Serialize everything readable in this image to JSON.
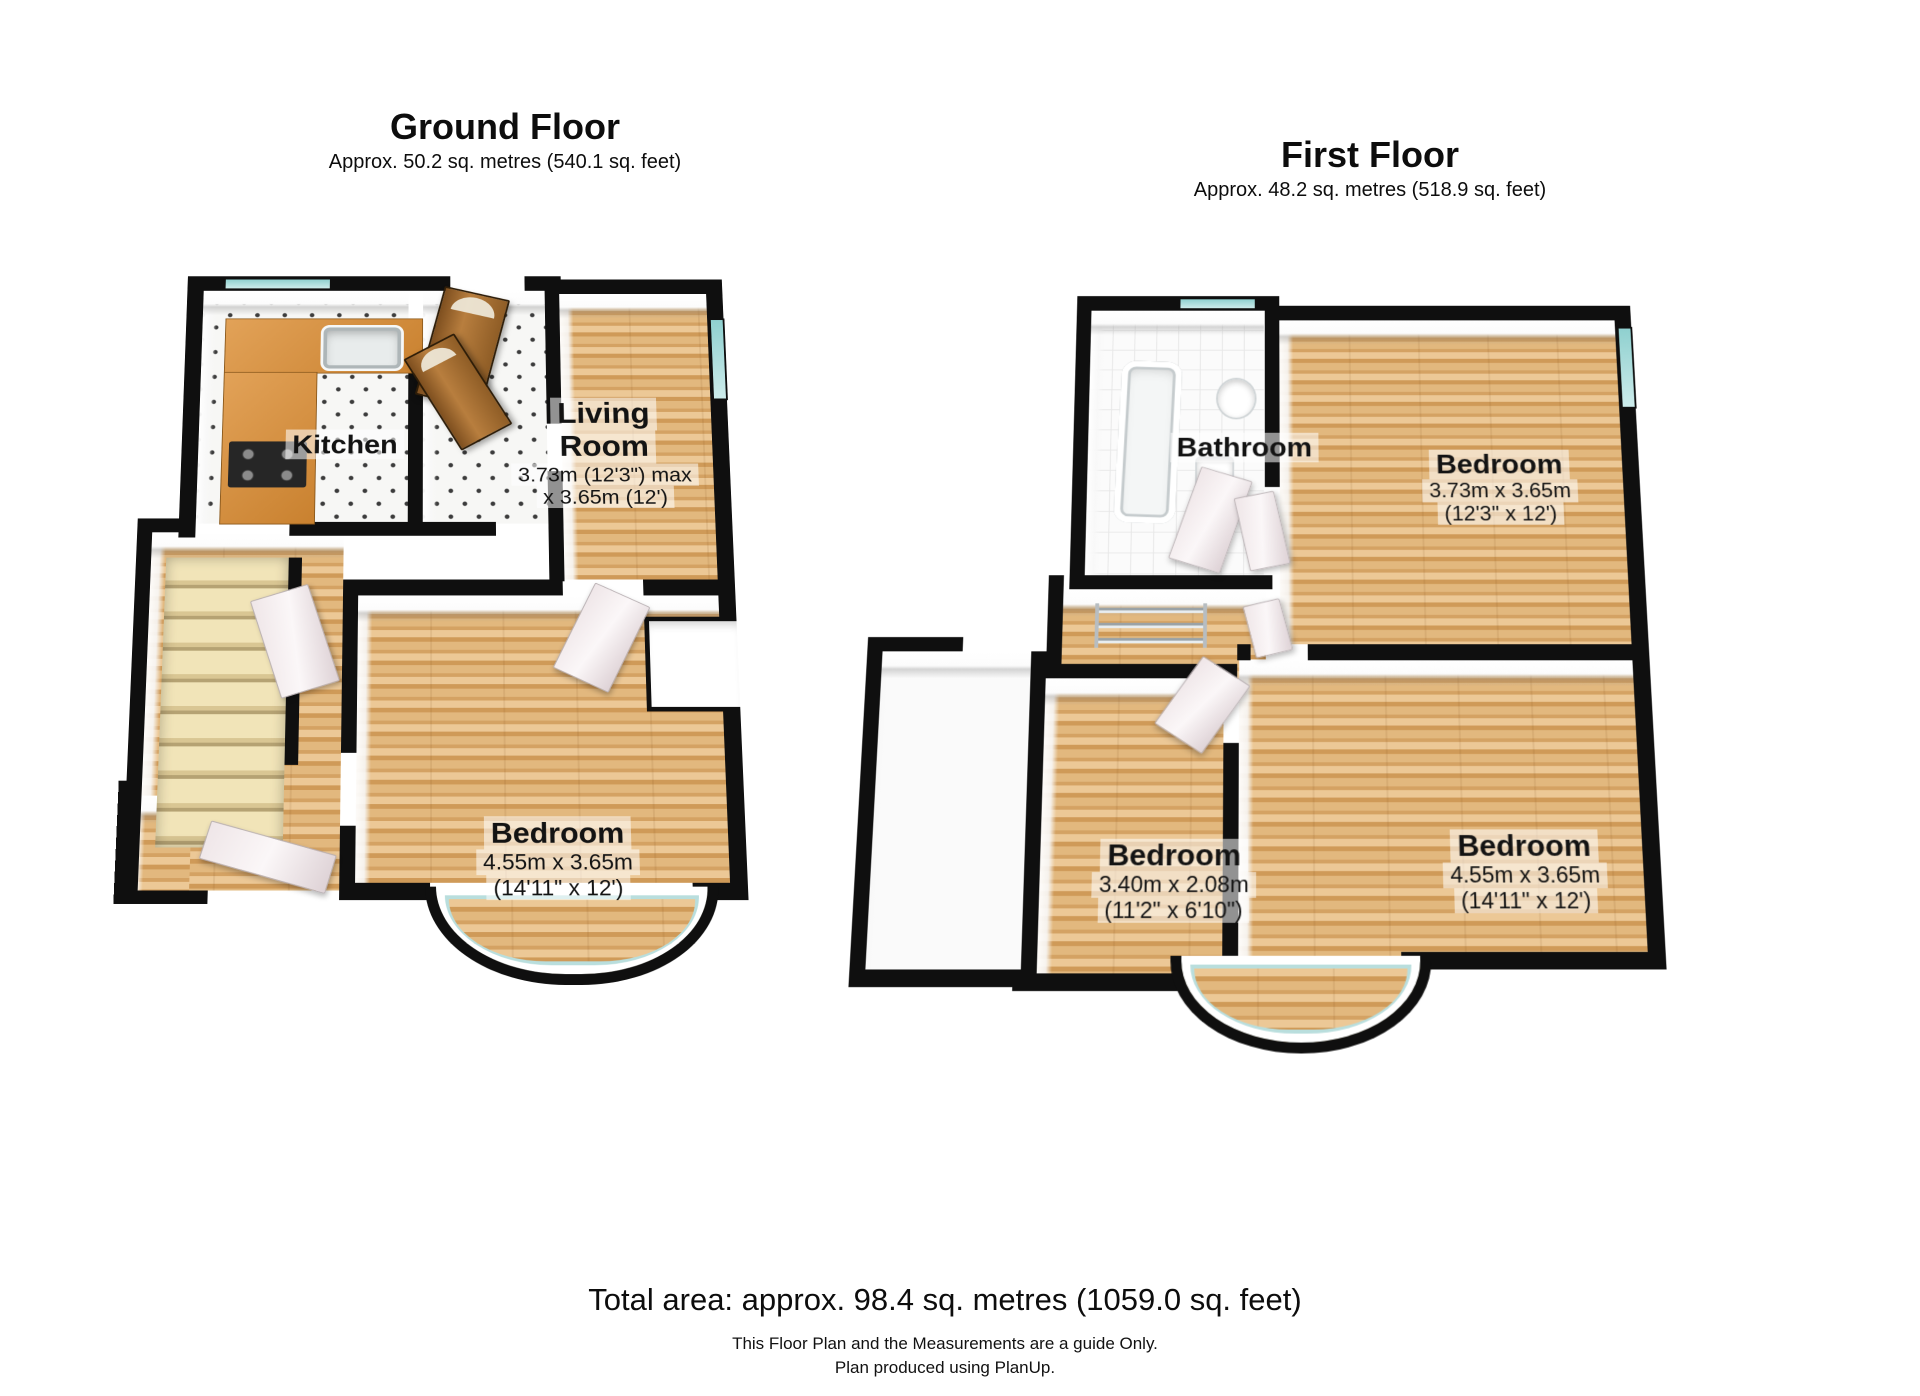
{
  "floors": {
    "ground": {
      "title": "Ground Floor",
      "subtitle": "Approx. 50.2 sq. metres (540.1 sq. feet)",
      "kitchen": {
        "name": "Kitchen"
      },
      "living_room": {
        "name_line1": "Living",
        "name_line2": "Room",
        "dims_line1": "3.73m (12'3\") max",
        "dims_line2": "x 3.65m (12')"
      },
      "bedroom": {
        "name": "Bedroom",
        "dims_metric": "4.55m x 3.65m",
        "dims_imperial": "(14'11\" x 12')"
      }
    },
    "first": {
      "title": "First Floor",
      "subtitle": "Approx. 48.2 sq. metres (518.9 sq. feet)",
      "bathroom": {
        "name": "Bathroom"
      },
      "bedroom_rear": {
        "name": "Bedroom",
        "dims_metric": "3.73m x 3.65m",
        "dims_imperial": "(12'3\" x 12')"
      },
      "bedroom_small": {
        "name": "Bedroom",
        "dims_metric": "3.40m x 2.08m",
        "dims_imperial": "(11'2\" x 6'10\")"
      },
      "bedroom_front": {
        "name": "Bedroom",
        "dims_metric": "4.55m x 3.65m",
        "dims_imperial": "(14'11\" x 12')"
      }
    }
  },
  "footer": {
    "total_area": "Total area: approx. 98.4 sq. metres (1059.0 sq. feet)",
    "disclaimer": "This Floor Plan and the Measurements are a guide Only.",
    "credit": "Plan produced using PlanUp."
  },
  "colors": {
    "wall": "#0f0f0f",
    "wood_light": "#ecc896",
    "wood_dark": "#cf9a58",
    "glass": "#9fd6d4",
    "counter": "#d98f3f",
    "stairs": "#f1e4b8",
    "label_bg": "rgba(255,255,255,0.55)"
  }
}
